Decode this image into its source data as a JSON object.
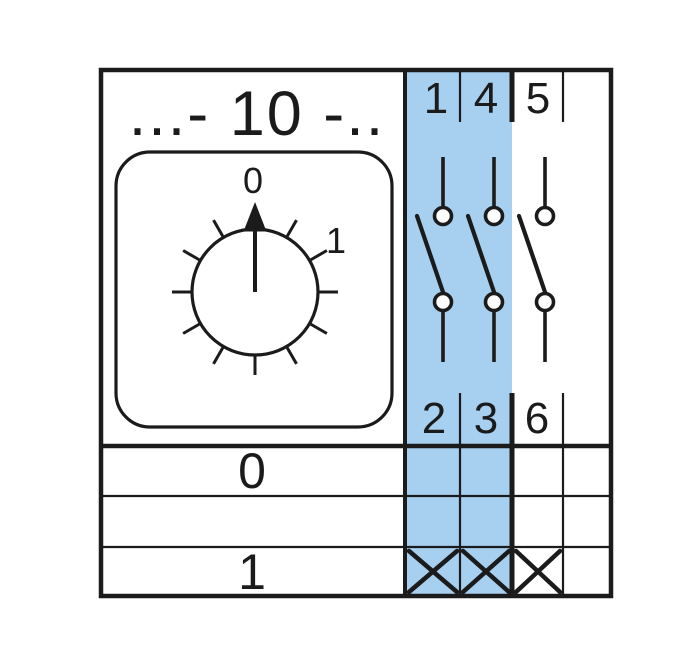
{
  "colors": {
    "highlight": "#a7cfef",
    "line": "#1b1b1b",
    "background": "#ffffff"
  },
  "title": "...- 10 -..",
  "dial": {
    "position_labels": [
      "0",
      "1"
    ]
  },
  "terminals": {
    "top": [
      "1",
      "4",
      "5"
    ],
    "bottom": [
      "2",
      "3",
      "6"
    ]
  },
  "contact_table": {
    "rows": [
      {
        "position": "0",
        "closed": [
          false,
          false,
          false,
          false
        ]
      },
      {
        "position": "",
        "closed": [
          false,
          false,
          false,
          false
        ]
      },
      {
        "position": "1",
        "closed": [
          true,
          true,
          true,
          false
        ]
      }
    ]
  }
}
